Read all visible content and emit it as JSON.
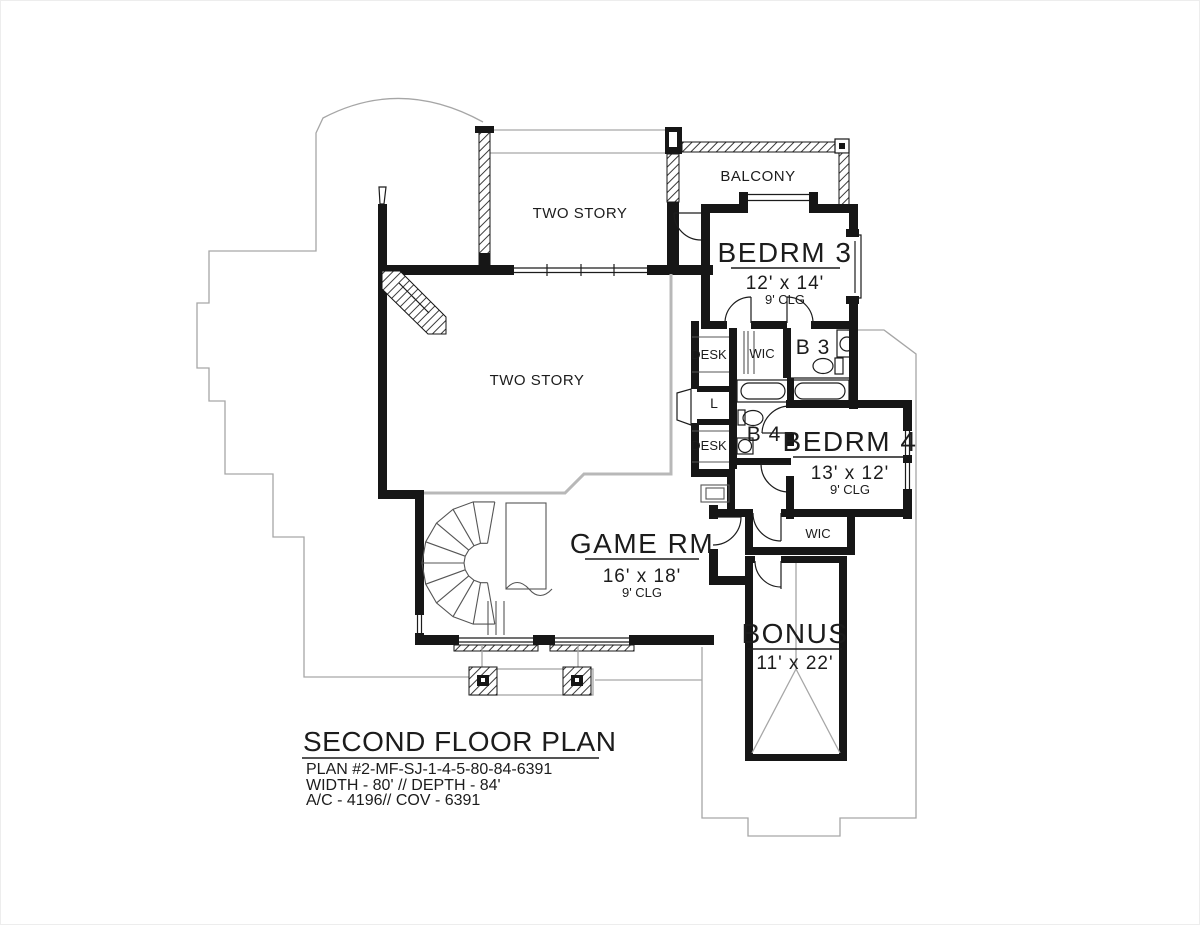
{
  "canvas": {
    "background": "#ffffff",
    "wall_color": "#161616",
    "roofline_gray": "#a6a6a6",
    "open_boundary_gray": "#b8b8b8"
  },
  "rooms": {
    "two_story_upper": {
      "label": "TWO STORY"
    },
    "balcony": {
      "label": "BALCONY"
    },
    "bedrm3": {
      "name": "BEDRM 3",
      "dims": "12' x 14'",
      "ceiling": "9' CLG"
    },
    "wic_upper": {
      "label": "WIC"
    },
    "bath3": {
      "label": "B 3"
    },
    "desk_upper": {
      "label": "DESK"
    },
    "linen": {
      "label": "L"
    },
    "bath4": {
      "label": "B 4"
    },
    "desk_lower": {
      "label": "DESK"
    },
    "bedrm4": {
      "name": "BEDRM 4",
      "dims": "13' x 12'",
      "ceiling": "9' CLG"
    },
    "two_story_main": {
      "label": "TWO STORY"
    },
    "game_room": {
      "name": "GAME RM",
      "dims": "16' x 18'",
      "ceiling": "9' CLG"
    },
    "wic_lower": {
      "label": "WIC"
    },
    "bonus": {
      "name": "BONUS",
      "dims": "11' x 22'"
    }
  },
  "title_block": {
    "title": "SECOND FLOOR PLAN",
    "plan_number": "PLAN #2-MF-SJ-1-4-5-80-84-6391",
    "dimensions": "WIDTH - 80' // DEPTH - 84'",
    "areas": "A/C - 4196// COV - 6391"
  }
}
